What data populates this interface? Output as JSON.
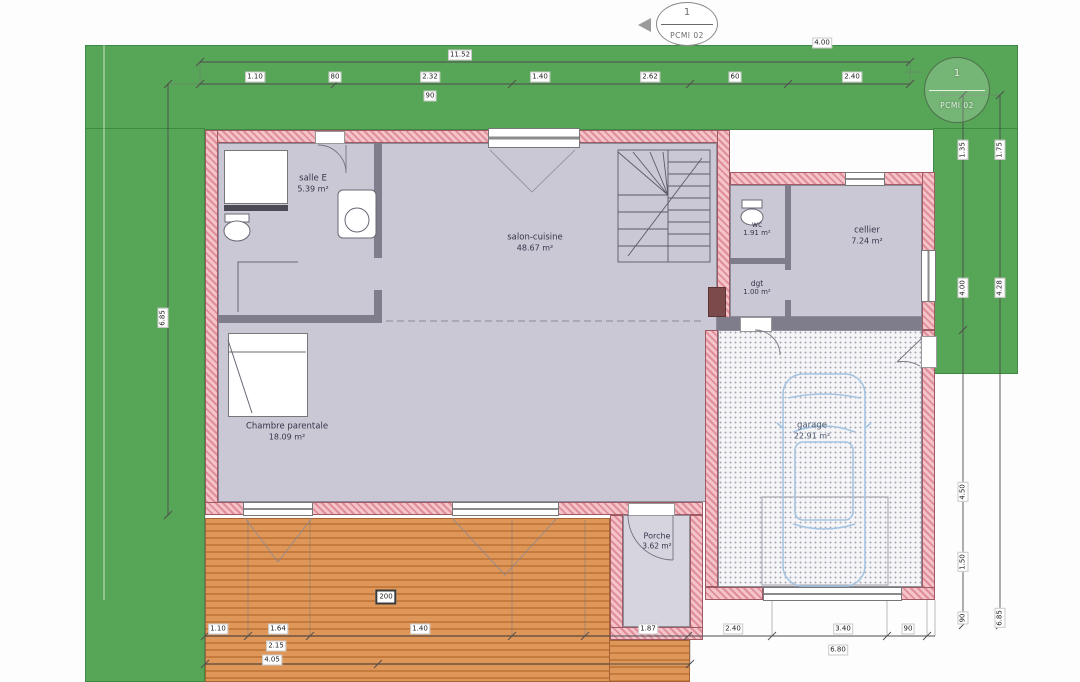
{
  "drawing": {
    "type": "house ground floor plan with garden, terrace and garage"
  },
  "markers": {
    "top": {
      "number": "1",
      "code": "PCMI 02"
    },
    "right": {
      "number": "1",
      "code": "PCMI 02"
    }
  },
  "rooms": {
    "salle_e": {
      "name": "salle E",
      "area": "5.39 m²"
    },
    "salon": {
      "name": "salon-cuisine",
      "area": "48.67 m²"
    },
    "wc": {
      "name": "wc",
      "area": "1.91 m²"
    },
    "dgt": {
      "name": "dgt",
      "area": "1.00 m²"
    },
    "cellier": {
      "name": "cellier",
      "area": "7.24 m²"
    },
    "chambre": {
      "name": "Chambre parentale",
      "area": "18.09 m²"
    },
    "garage": {
      "name": "garage",
      "area": "22.91 m²"
    },
    "porche": {
      "name": "Porche",
      "area": "3.62 m²"
    }
  },
  "dims": {
    "top_a_total": "11.52",
    "top_a_right": "4.00",
    "top_b": [
      "1.10",
      "80",
      "2.32",
      "1.40",
      "2.62",
      "60",
      "2.40"
    ],
    "top_b_sub": "90",
    "left_total": "6.85",
    "right_inner": [
      "1.35",
      "4.00",
      "4.50",
      "1.50",
      "90"
    ],
    "right_outer": [
      "1.75",
      "4.28",
      "6.85"
    ],
    "bottom": [
      "1.10",
      "1.64",
      "1.40",
      "1.87",
      "2.40",
      "3.40",
      "90"
    ],
    "bottom_sub": "2.15",
    "garage_total": "6.80",
    "terrace_total": "4.05",
    "terrace_step": "200"
  },
  "colors": {
    "garden_green": "#57a557",
    "wall_pink": "#f5c3ca",
    "wall_hatch_red": "#e08e9a",
    "interior_gray": "#cac8d4",
    "terrace_orange": "#df9659",
    "car_blue": "#a3c4e2"
  }
}
